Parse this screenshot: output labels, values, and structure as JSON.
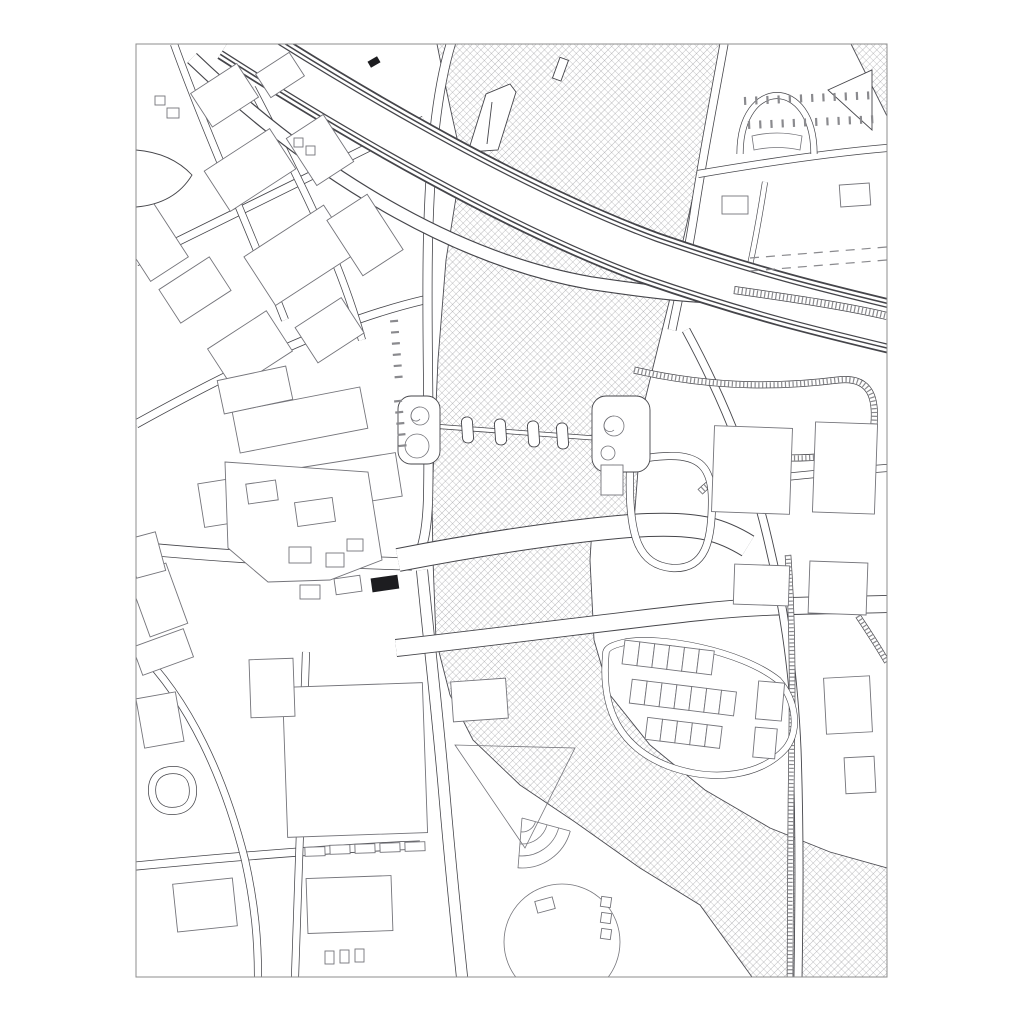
{
  "map": {
    "kind": "architectural-site-plan",
    "style": "black-and-white line drawing, river rendered with diagonal crosshatch, site highlighted as solid black building",
    "frame": {
      "x": 136,
      "y": 44,
      "width": 751,
      "height": 933
    }
  },
  "colors": {
    "paper": "#ffffff",
    "frame": "#8d8d8d",
    "line": "#45454a",
    "linelight": "#8a8a8e",
    "bld": "#74747a",
    "bank": "#4c4c52",
    "hatch": "#8f8f94",
    "marker": "#1d1d20"
  },
  "features": [
    {
      "name": "river",
      "fill": "crosshatch"
    },
    {
      "name": "motorway-bridge",
      "note": "wide curved band crossing river, multi-line edges"
    },
    {
      "name": "pontoon-footbridge",
      "note": "walkway with four pontoons and spiral ramps"
    },
    {
      "name": "road-bridges",
      "count": 2
    },
    {
      "name": "railway-viaduct",
      "note": "ticked ribbon crossing river and looping at interchange"
    },
    {
      "name": "dashed-rail-tracks",
      "count": 2
    },
    {
      "name": "arch-park-road"
    },
    {
      "name": "housing-estate-grid"
    },
    {
      "name": "amphitheater-steps"
    },
    {
      "name": "traffic-circle"
    },
    {
      "name": "parking-bays"
    },
    {
      "name": "site-marker",
      "fill": "solid-black"
    },
    {
      "name": "building-footprints"
    },
    {
      "name": "street-network"
    }
  ]
}
